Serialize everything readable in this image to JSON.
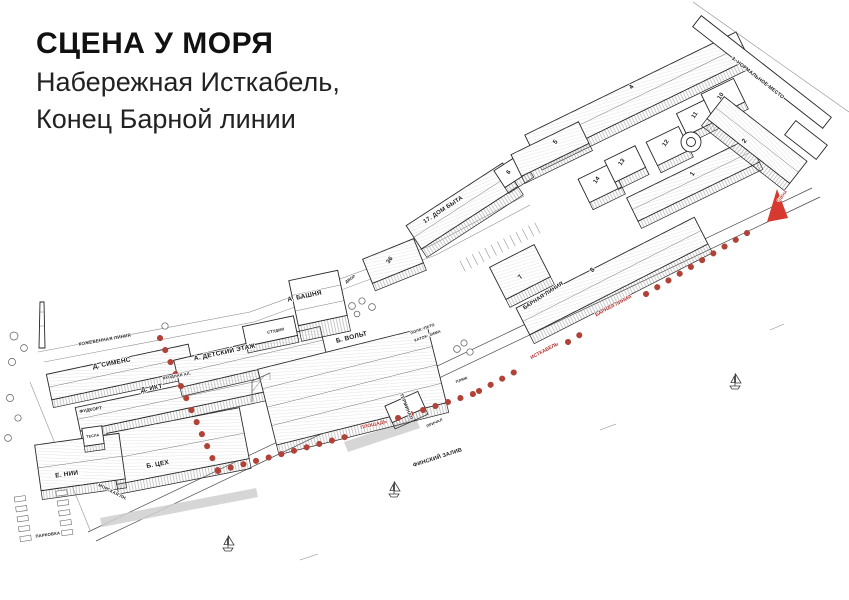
{
  "header": {
    "title": "СЦЕНА У МОРЯ",
    "subtitle1": "Набережная Исткабель,",
    "subtitle2": "Конец Барной линии"
  },
  "map": {
    "ink": "#1f1f1f",
    "streets": {
      "kozhevennaya": "КОЖЕВЕННАЯ ЛИНИЯ",
      "vkhodnaya": "ВХОДНАЯ АЛ.",
      "morskaya": "МОРСКАЯ ЛН.",
      "parking": "ПАРКОВКА",
      "gulf": "ФИНСКИЙ ЗАЛИВ",
      "prichal": "ПРИЧАЛ",
      "dvor": "ДВОР",
      "plyazh": "ПЛЯЖ",
      "pole_summer": "ПОЛЕ: ЛЕТО",
      "katok_winter": "КАТОК: ЗИМА"
    },
    "buildings": {
      "siemens": "Д. СИМЕНС",
      "ikt": "Д. ИКТ",
      "detskiy": "А. ДЕТСКИЙ ЭТАЖ",
      "bashnya": "А. БАШНЯ",
      "studii": "СТУДИИ",
      "volt": "Б. ВОЛЬТ",
      "tsekh": "Б. ЦЕХ",
      "nii": "Е. НИИ",
      "tesla": "ТЕСЛА",
      "foodcourt": "ФУДКОРТ",
      "terminal": "ТЕРМИНАЛ",
      "dom_byta": "17. ДОМ БЫТА",
      "barnaya": "БАРНАЯ ЛИНИЯ",
      "normalnoe": "3. НОРМАЛЬНОЕ МЕСТО",
      "n36": "36",
      "n1": "1",
      "n2": "2",
      "n4": "4",
      "n5": "5",
      "n6": "6",
      "n7": "7",
      "n8": "8",
      "n10": "10",
      "n11": "11",
      "n12": "12",
      "n13": "13",
      "n14": "14"
    },
    "route": {
      "ploshchad": "ПЛОЩАДЬ",
      "istkabel": "ИСТКАБЕЛЬ",
      "barnaya": "БАРНАЯ ЛИНИЯ",
      "stsena": "СЦЕНА",
      "dot_color": "#b04238",
      "arrow_color": "#d63a2e",
      "label_color": "#b03530"
    }
  }
}
